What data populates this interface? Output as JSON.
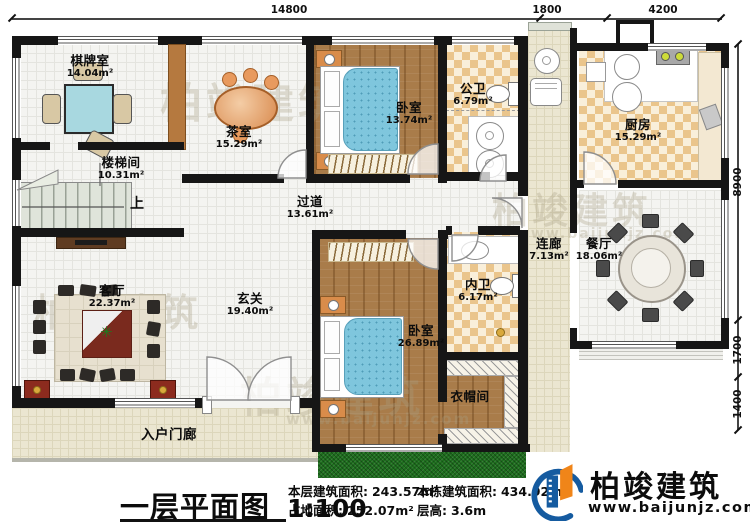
{
  "plan": {
    "dimensions_top": [
      "14800",
      "1800",
      "4200"
    ],
    "dimensions_right": [
      "8900",
      "1700",
      "1400"
    ],
    "rooms": [
      {
        "name": "棋牌室",
        "area": "14.04m²"
      },
      {
        "name": "茶室",
        "area": "15.29m²"
      },
      {
        "name": "卧室",
        "area": "13.74m²"
      },
      {
        "name": "公卫",
        "area": "6.79m²"
      },
      {
        "name": "厨房",
        "area": "15.29m²"
      },
      {
        "name": "楼梯间",
        "area": "10.31m²"
      },
      {
        "name": "过道",
        "area": "13.61m²"
      },
      {
        "name": "连廊",
        "area": "7.13m²"
      },
      {
        "name": "餐厅",
        "area": "18.06m²"
      },
      {
        "name": "客厅",
        "area": "22.37m²"
      },
      {
        "name": "玄关",
        "area": "19.40m²"
      },
      {
        "name": "卧室",
        "area": "26.89m²"
      },
      {
        "name": "内卫",
        "area": "6.17m²"
      },
      {
        "name": "衣帽间",
        "area": ""
      },
      {
        "name": "入户门廊",
        "area": ""
      }
    ],
    "stair_up_label": "上"
  },
  "footer": {
    "title": "一层平面图",
    "scale": "1:100",
    "stats": [
      {
        "label": "本层建筑面积:",
        "value": "243.57m²"
      },
      {
        "label": "占地面积:",
        "value": "252.07m²"
      },
      {
        "label": "本栋建筑面积:",
        "value": "434.92m²"
      },
      {
        "label": "层高:",
        "value": "3.6m"
      }
    ]
  },
  "brand": {
    "name": "柏竣建筑",
    "website": "www.baijunjz.com"
  },
  "watermark": {
    "text": "柏竣建筑",
    "subtext": "www.baijunjz.com"
  },
  "colors": {
    "wall": "#161616",
    "wood": "#a97c4a",
    "checker": "#eac58c",
    "tile": "#ebe6d1",
    "grass": "#1d6e1d",
    "bed_blue": "#7fc6dd",
    "brand_blue": "#155ba0",
    "brand_orange": "#f08519"
  }
}
